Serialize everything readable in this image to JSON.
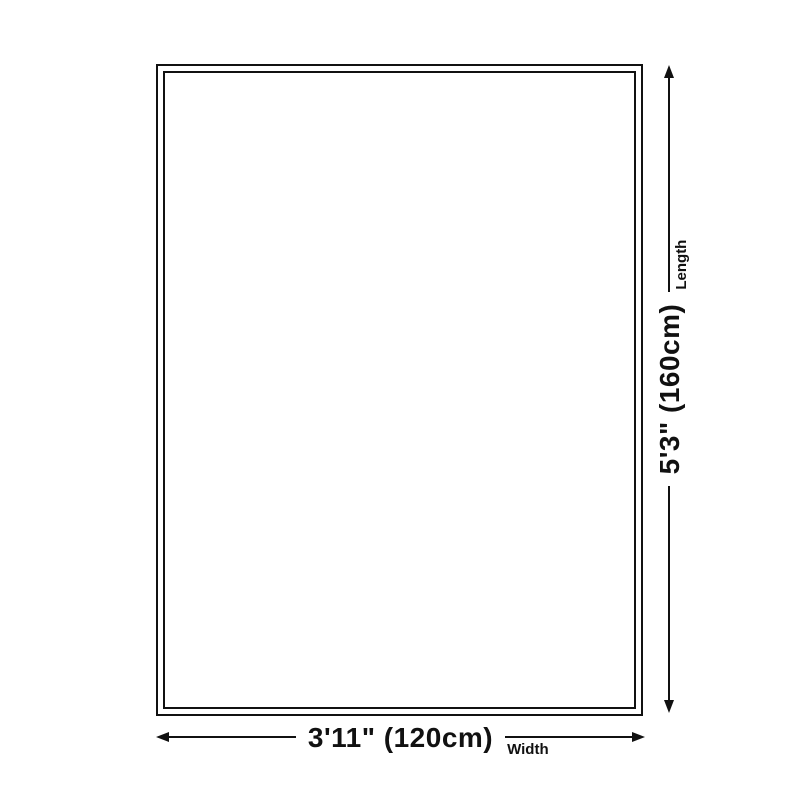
{
  "diagram": {
    "background_color": "#ffffff",
    "line_color": "#111111",
    "width": {
      "value": "3'11\" (120cm)",
      "axis_label": "Width"
    },
    "length": {
      "value": "5'3\" (160cm)",
      "axis_label": "Length"
    }
  }
}
